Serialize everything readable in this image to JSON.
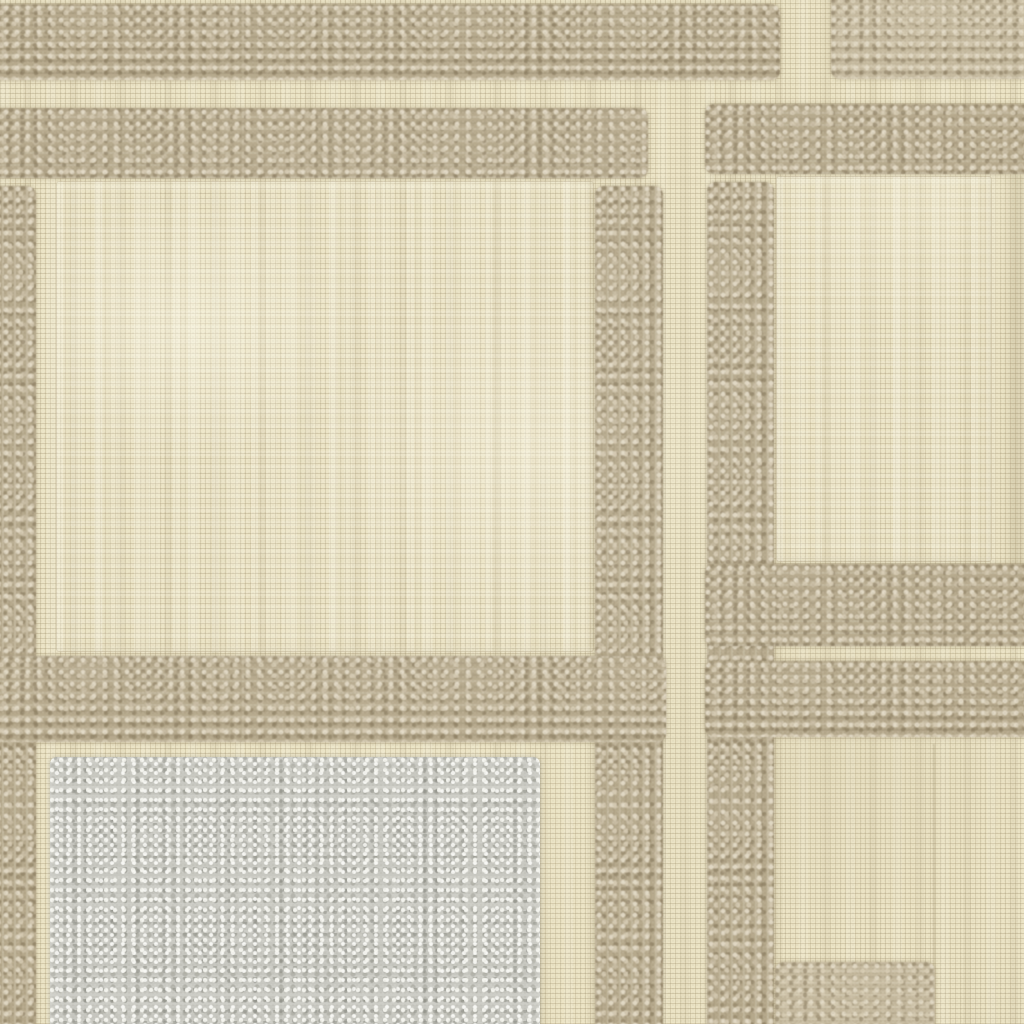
{
  "image": {
    "type": "photograph",
    "subject": "woven-textile-swatch-closeup",
    "description": "Macro photo of a cream basketweave fabric with raised taupe chenille bands forming a grid of framed squares; a plush pale-gray bouclé square sits at the lower left. No text or UI elements are present.",
    "palette": {
      "cream_base": "#ebe3c4",
      "cream_highlight": "#f5efd8",
      "weave_grid_line": "#c7bb96",
      "taupe_band": "#b5a88b",
      "taupe_band_light": "#d9cfb6",
      "taupe_band_dark": "#8d8063",
      "gray_square": "#c7c7c0",
      "gray_highlight": "#edebe5",
      "gray_shadow": "#999a91"
    }
  },
  "regions": [
    {
      "name": "satin-panel-center",
      "kind": "satin",
      "x": 56,
      "y": 181,
      "w": 538,
      "h": 471
    },
    {
      "name": "satin-panel-right",
      "kind": "satin",
      "x": 776,
      "y": 176,
      "w": 216,
      "h": 386
    },
    {
      "name": "weave-shade-right-edge",
      "kind": "shade",
      "x": 1000,
      "y": 176,
      "w": 24,
      "h": 390
    },
    {
      "name": "weave-seam-bottom-right",
      "kind": "seam",
      "x": 933,
      "y": 744,
      "w": 2,
      "h": 280
    },
    {
      "name": "chenille-band-top-left",
      "kind": "band h",
      "x": -8,
      "y": 4,
      "w": 788,
      "h": 76
    },
    {
      "name": "chenille-band-top-right",
      "kind": "band h light",
      "x": 831,
      "y": -8,
      "w": 201,
      "h": 87
    },
    {
      "name": "chenille-band-second-left",
      "kind": "band h",
      "x": -8,
      "y": 108,
      "w": 656,
      "h": 70
    },
    {
      "name": "chenille-band-second-right",
      "kind": "band h",
      "x": 705,
      "y": 104,
      "w": 327,
      "h": 70
    },
    {
      "name": "chenille-band-left-edge",
      "kind": "band v",
      "x": -10,
      "y": 186,
      "w": 46,
      "h": 848
    },
    {
      "name": "chenille-band-center-vertical",
      "kind": "band v",
      "x": 595,
      "y": 186,
      "w": 68,
      "h": 848
    },
    {
      "name": "chenille-band-right-vertical",
      "kind": "band v",
      "x": 707,
      "y": 182,
      "w": 67,
      "h": 852
    },
    {
      "name": "chenille-band-bottom-center",
      "kind": "band h",
      "x": -8,
      "y": 656,
      "w": 674,
      "h": 86
    },
    {
      "name": "chenille-band-right-mid-upper",
      "kind": "band h",
      "x": 705,
      "y": 564,
      "w": 327,
      "h": 82
    },
    {
      "name": "chenille-band-right-mid-lower",
      "kind": "band h",
      "x": 705,
      "y": 661,
      "w": 327,
      "h": 76
    },
    {
      "name": "chenille-band-bottom-right-stub",
      "kind": "band h light",
      "x": 775,
      "y": 962,
      "w": 160,
      "h": 70
    },
    {
      "name": "plush-square-gray",
      "kind": "gray-sq",
      "x": 50,
      "y": 757,
      "w": 490,
      "h": 275
    }
  ]
}
